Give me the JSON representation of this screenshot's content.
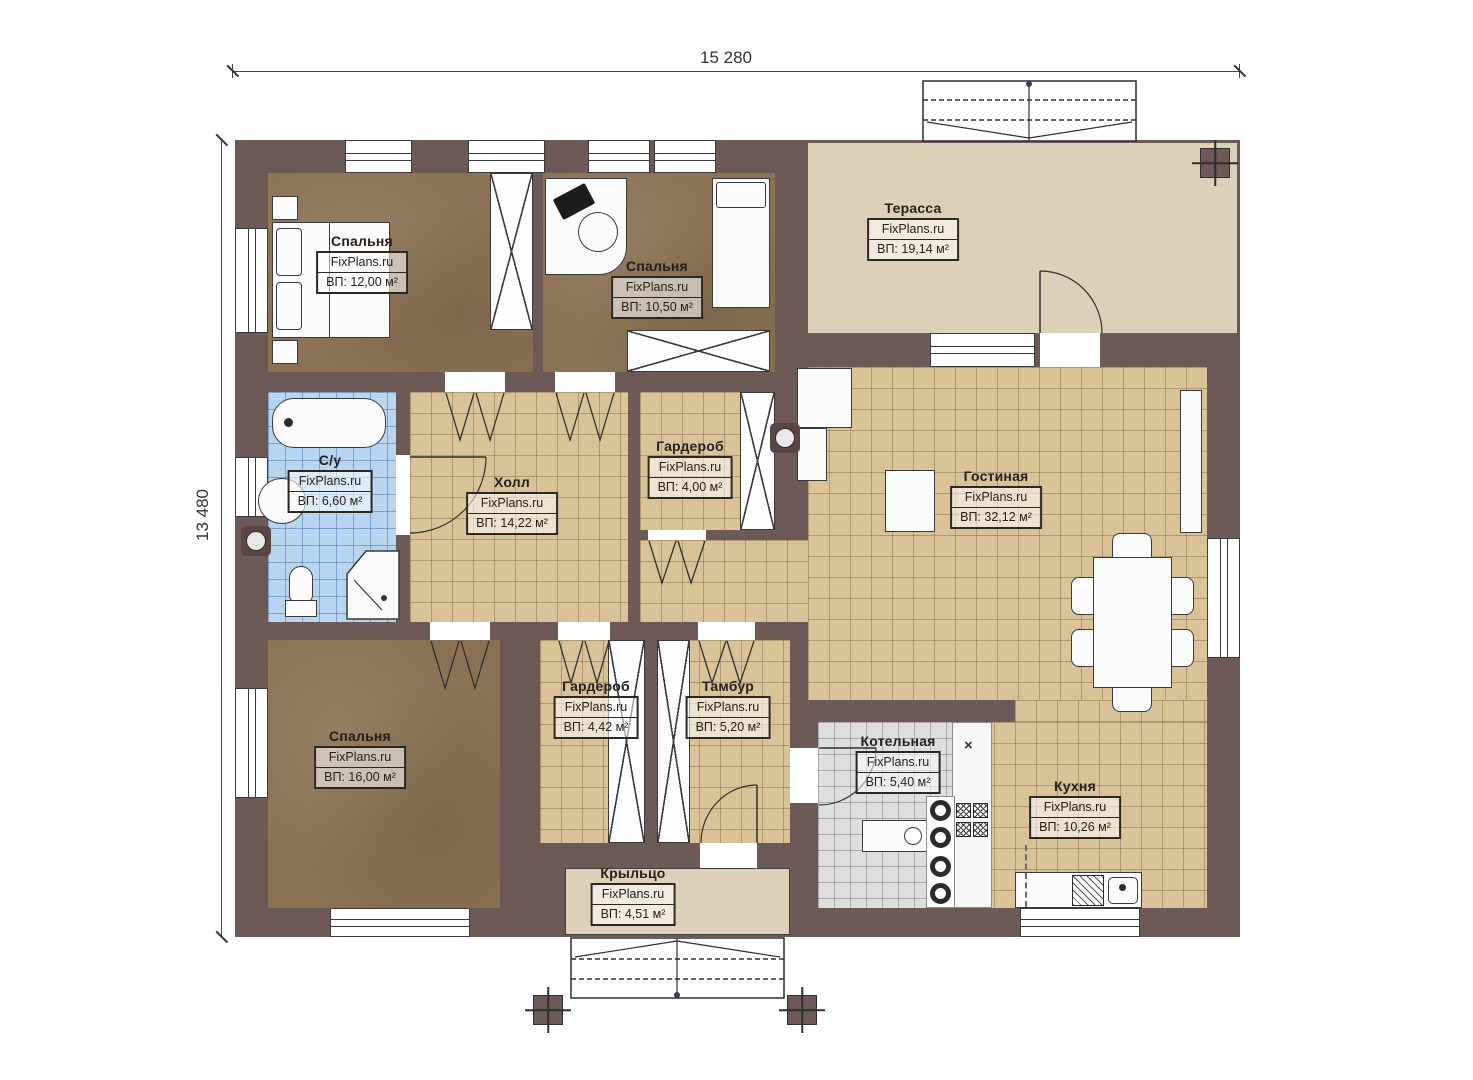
{
  "watermark": "FixPlans.ru",
  "dimensions": {
    "width_label": "15 280",
    "height_label": "13 480"
  },
  "marks": {
    "vent_cross": "×"
  },
  "rooms": [
    {
      "id": "bedroom-1",
      "name": "Спальня",
      "area": "ВП: 12,00 м²"
    },
    {
      "id": "bedroom-2",
      "name": "Спальня",
      "area": "ВП: 10,50 м²"
    },
    {
      "id": "terrace",
      "name": "Терасса",
      "area": "ВП: 19,14 м²"
    },
    {
      "id": "bathroom",
      "name": "С/у",
      "area": "ВП: 6,60 м²"
    },
    {
      "id": "hall",
      "name": "Холл",
      "area": "ВП: 14,22 м²"
    },
    {
      "id": "wardrobe-top",
      "name": "Гардероб",
      "area": "ВП: 4,00 м²"
    },
    {
      "id": "living-room",
      "name": "Гостиная",
      "area": "ВП: 32,12 м²"
    },
    {
      "id": "bedroom-3",
      "name": "Спальня",
      "area": "ВП: 16,00 м²"
    },
    {
      "id": "wardrobe-bottom",
      "name": "Гардероб",
      "area": "ВП: 4,42 м²"
    },
    {
      "id": "vestibule",
      "name": "Тамбур",
      "area": "ВП: 5,20 м²"
    },
    {
      "id": "boiler-room",
      "name": "Котельная",
      "area": "ВП: 5,40 м²"
    },
    {
      "id": "kitchen",
      "name": "Кухня",
      "area": "ВП: 10,26 м²"
    },
    {
      "id": "porch",
      "name": "Крыльцо",
      "area": "ВП: 4,51 м²"
    }
  ],
  "colors": {
    "wall": "#6d5955",
    "tile_floor": "#d9c298",
    "bedroom_floor": "#8b7254",
    "bathroom_tile": "#b7d4f1",
    "boiler_tile": "#dedede",
    "terrace_floor": "#ddd0b8"
  }
}
